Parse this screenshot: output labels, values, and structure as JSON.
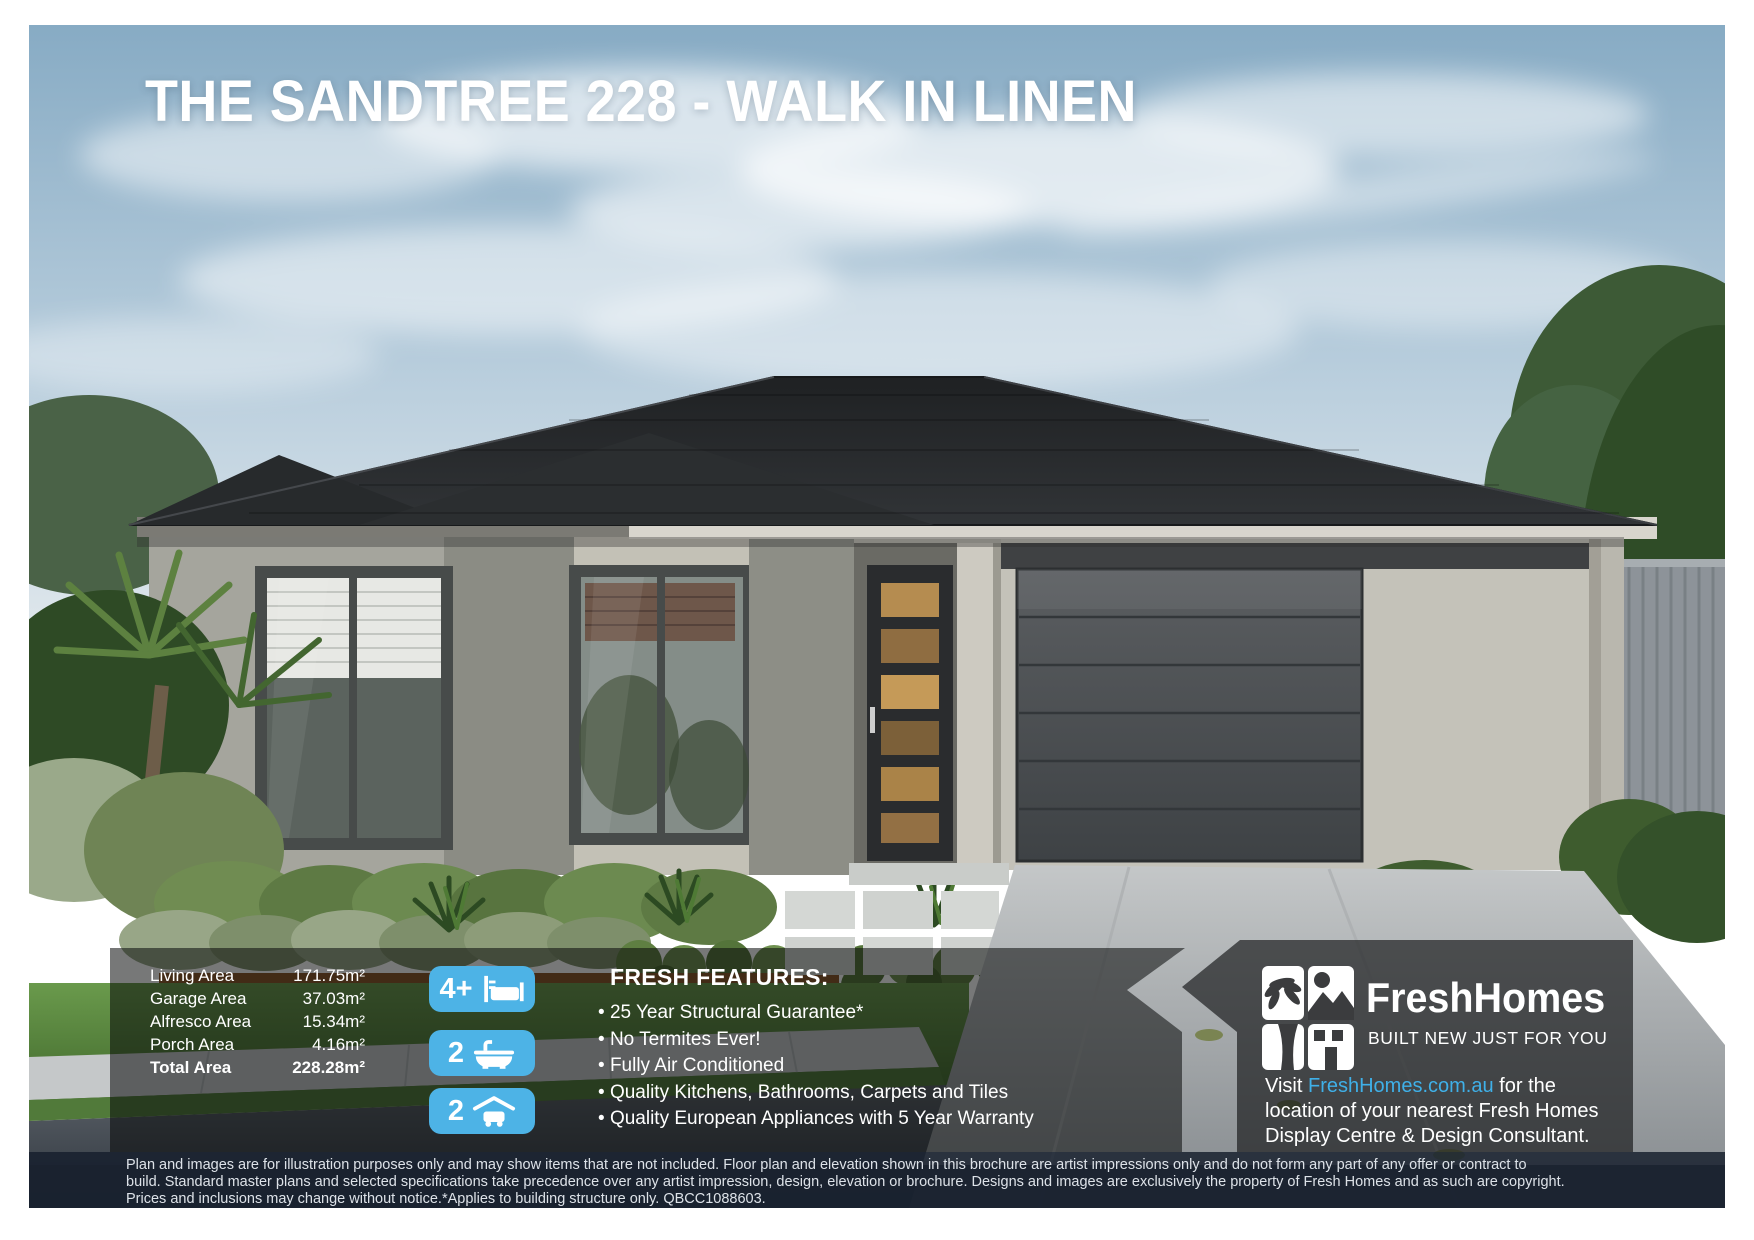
{
  "page": {
    "title": "THE SANDTREE 228 - WALK IN LINEN"
  },
  "areas": {
    "rows": [
      {
        "label": "Living Area",
        "value": "171.75m²"
      },
      {
        "label": "Garage Area",
        "value": "37.03m²"
      },
      {
        "label": "Alfresco Area",
        "value": "15.34m²"
      },
      {
        "label": "Porch Area",
        "value": "4.16m²"
      },
      {
        "label": "Total Area",
        "value": "228.28m²"
      }
    ]
  },
  "badges": [
    {
      "count": "4+",
      "icon": "bed-icon"
    },
    {
      "count": "2",
      "icon": "bath-icon"
    },
    {
      "count": "2",
      "icon": "garage-icon"
    }
  ],
  "features": {
    "heading": "FRESH FEATURES:",
    "items": [
      "25 Year Structural Guarantee*",
      "No Termites Ever!",
      "Fully Air Conditioned",
      "Quality Kitchens, Bathrooms, Carpets and Tiles",
      "Quality European Appliances with 5 Year Warranty"
    ]
  },
  "brand": {
    "name": "FreshHomes",
    "tagline": "BUILT NEW JUST FOR YOU",
    "visit_prefix": "Visit ",
    "visit_link": "FreshHomes.com.au",
    "visit_suffix": " for the",
    "visit_line2": "location of your nearest Fresh Homes",
    "visit_line3": "Display Centre & Design Consultant."
  },
  "disclaimer": {
    "lines": [
      "Plan and images are for illustration purposes only and may show items that are not included. Floor plan and elevation shown in this brochure are artist impressions only and do not form any part of any offer or contract to",
      "build. Standard master plans and selected specifications take precedence over any artist impression, design, elevation or brochure. Designs and images are exclusively the property of Fresh Homes and as such are copyright.",
      "Prices and inclusions may change without notice.*Applies to building structure only. QBCC1088603."
    ]
  },
  "colors": {
    "badge_blue": "#4db3e6",
    "link_blue": "#3fb0e8",
    "roof_charcoal": "#27292b",
    "wall_greige": "#b9b7ae",
    "band_dark": "rgba(8,9,10,0.55)",
    "panel_dark": "rgba(24,25,27,0.68)",
    "disclaimer_band": "rgba(22,30,44,0.83)"
  }
}
